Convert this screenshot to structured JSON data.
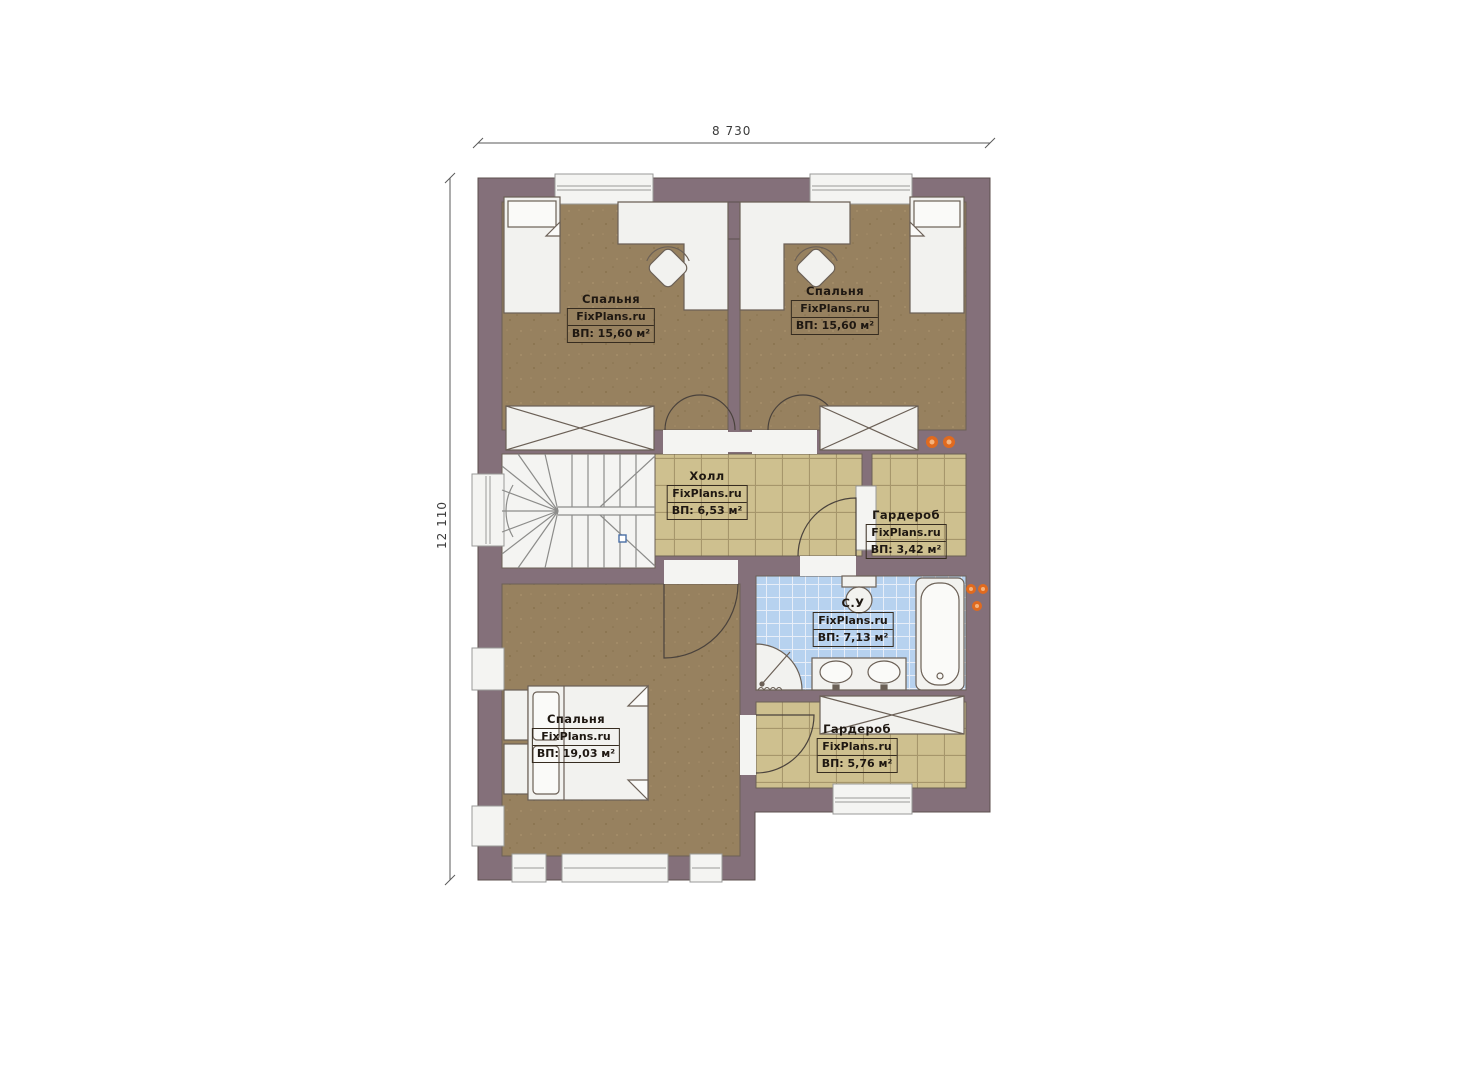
{
  "dimensions": {
    "width_label": "8 730",
    "height_label": "12 110"
  },
  "watermark": "FixPlans.ru",
  "rooms": {
    "bedroom_top_left": {
      "name": "Спальня",
      "source": "FixPlans.ru",
      "area": "ВП: 15,60 м²"
    },
    "bedroom_top_right": {
      "name": "Спальня",
      "source": "FixPlans.ru",
      "area": "ВП: 15,60 м²"
    },
    "hall": {
      "name": "Холл",
      "source": "FixPlans.ru",
      "area": "ВП: 6,53 м²"
    },
    "wardrobe_upper": {
      "name": "Гардероб",
      "source": "FixPlans.ru",
      "area": "ВП: 3,42 м²"
    },
    "bathroom": {
      "name": "С.У",
      "source": "FixPlans.ru",
      "area": "ВП: 7,13 м²"
    },
    "bedroom_bottom": {
      "name": "Спальня",
      "source": "FixPlans.ru",
      "area": "ВП: 19,03 м²"
    },
    "wardrobe_lower": {
      "name": "Гардероб",
      "source": "FixPlans.ru",
      "area": "ВП: 5,76 м²"
    }
  },
  "colors": {
    "wall": "#84707a",
    "bedroom_floor": "#97815f",
    "tile_floor": "#cec08f",
    "tile_grout": "#a6966b",
    "bath_tile": "#b7d2ef",
    "bath_grout": "#e8eef8",
    "fixture_white": "#f2f2ef",
    "outline": "#6b6056",
    "accent_orange": "#e06a1f"
  }
}
